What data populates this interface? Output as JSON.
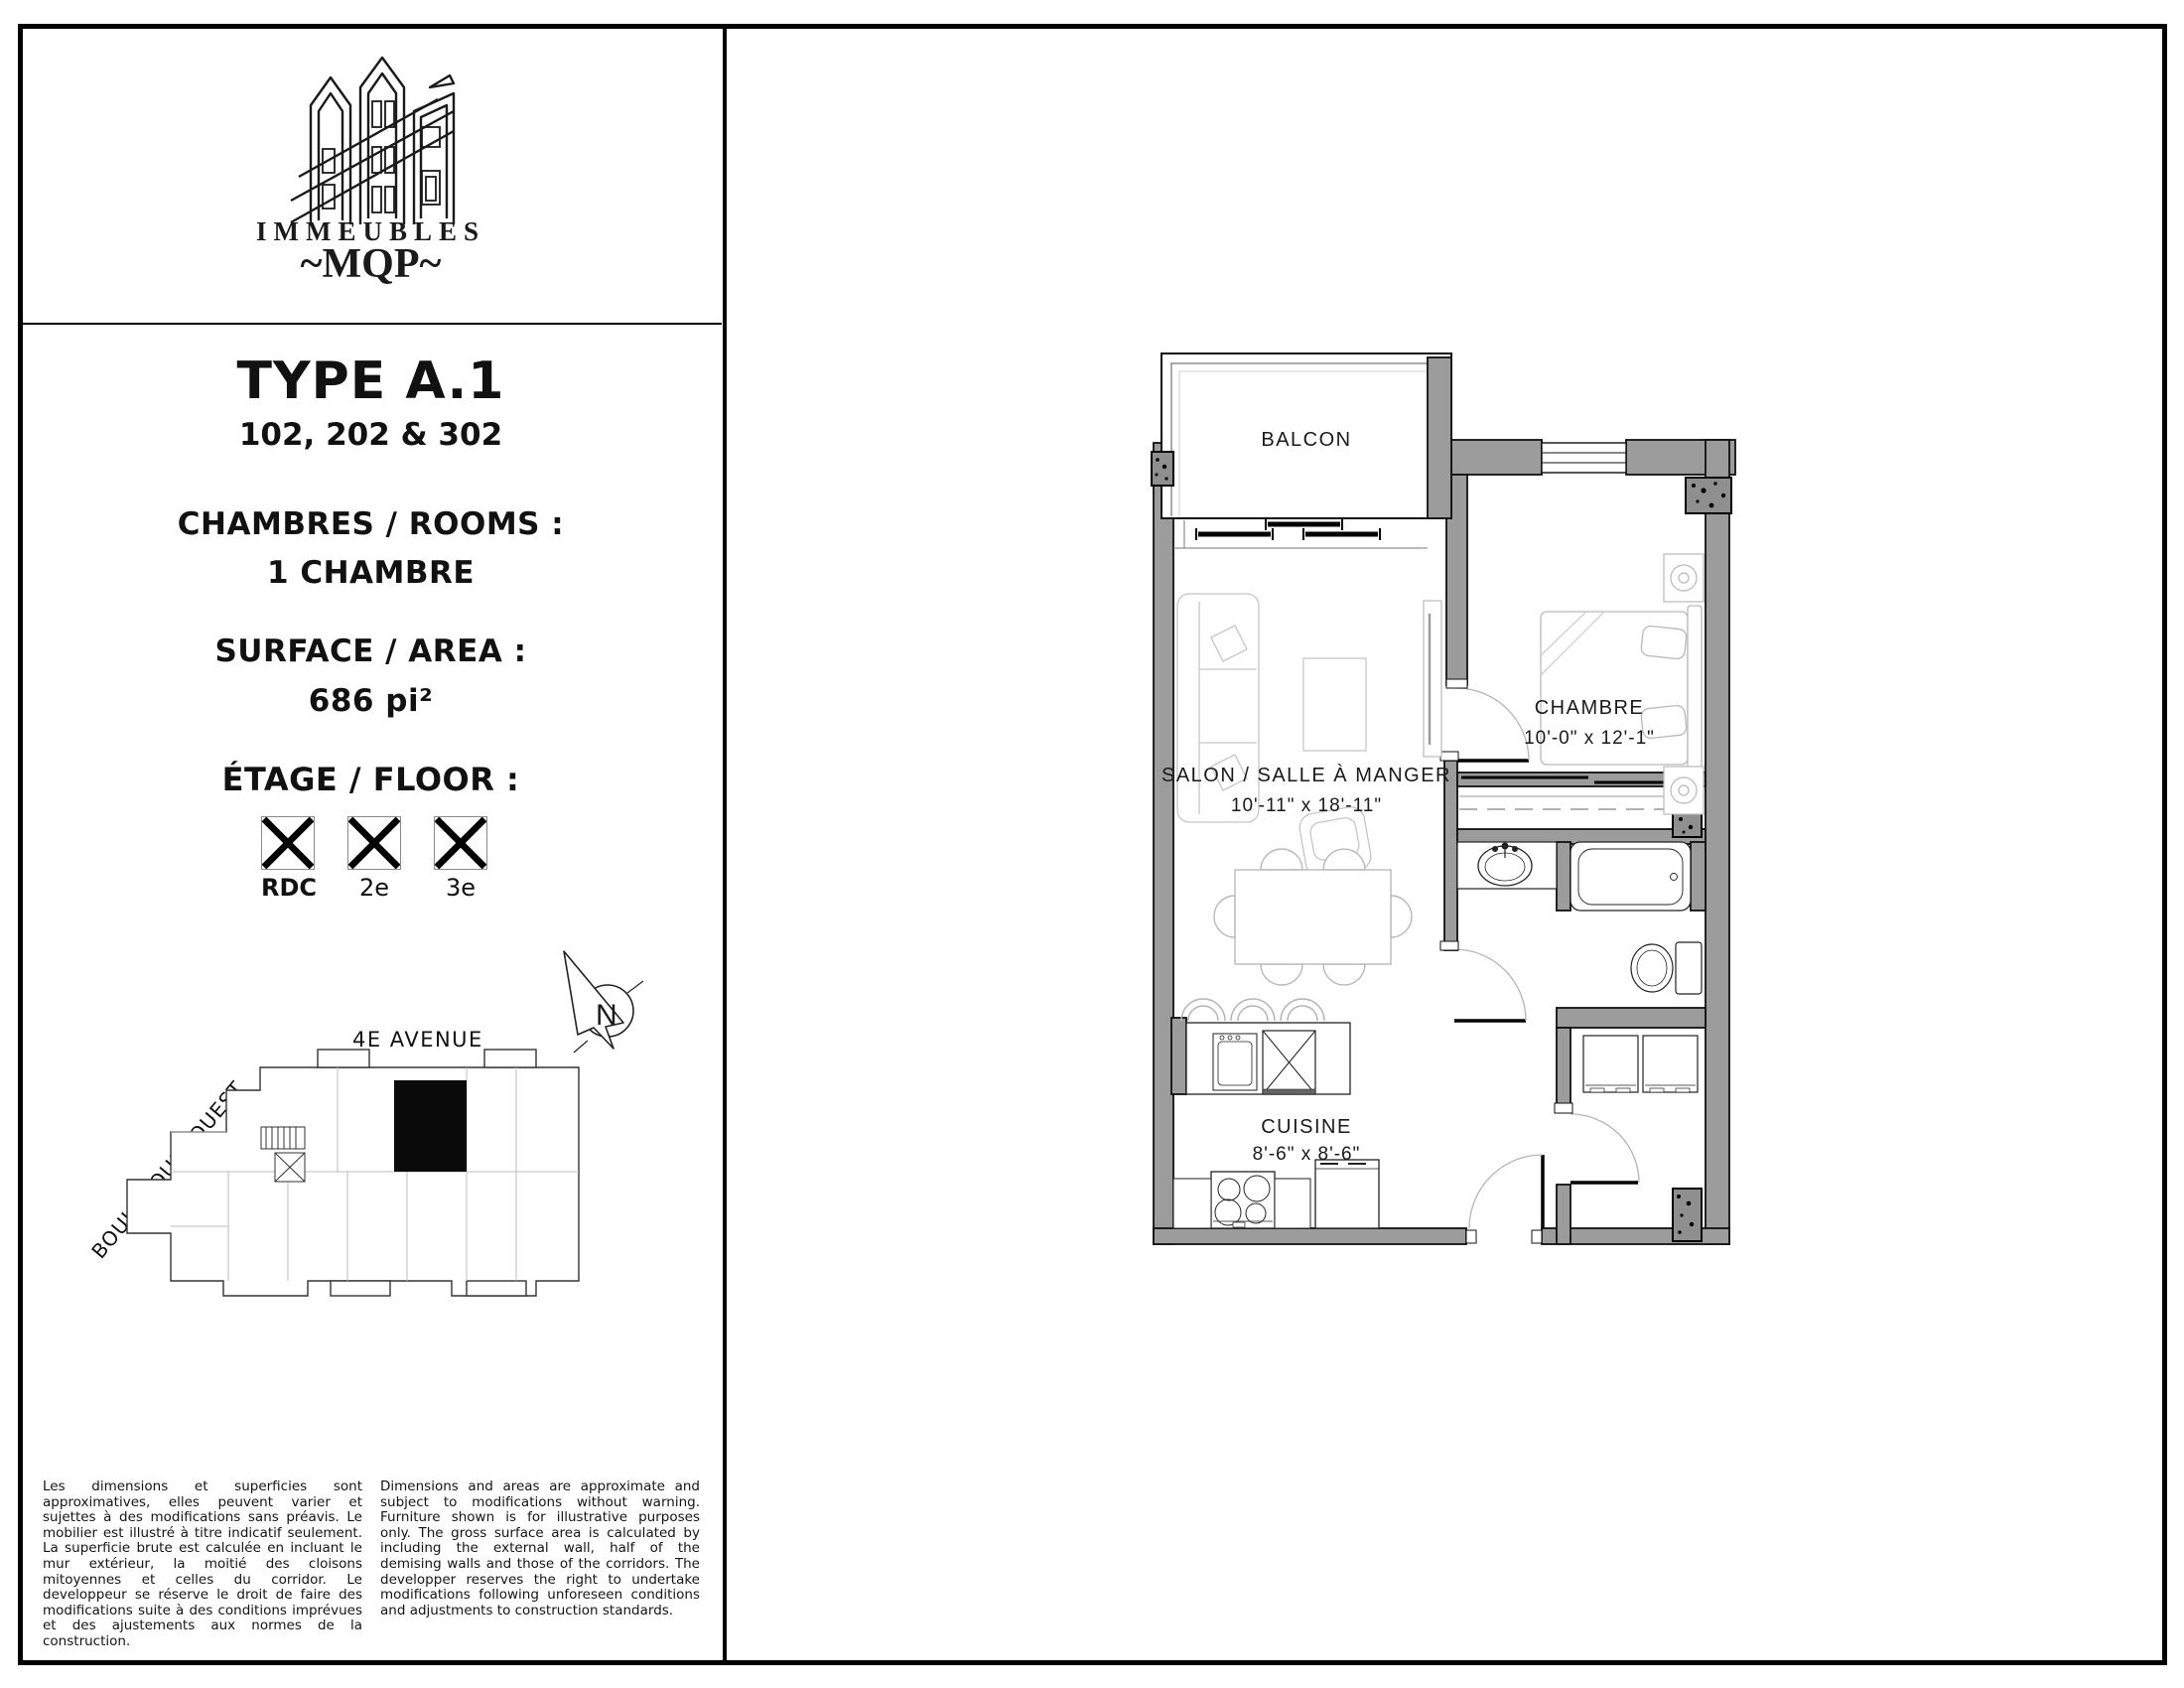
{
  "brand": {
    "name_line": "IMMEUBLES",
    "monogram": "~MQP~"
  },
  "spec": {
    "type_title": "TYPE A.1",
    "unit_numbers": "102, 202 & 302",
    "rooms_label": "CHAMBRES / ROOMS :",
    "rooms_value": "1 CHAMBRE",
    "area_label": "SURFACE / AREA :",
    "area_value": "686 pi²",
    "floor_label": "ÉTAGE / FLOOR :",
    "floors": [
      {
        "label": "RDC"
      },
      {
        "label": "2e"
      },
      {
        "label": "3e"
      }
    ]
  },
  "site": {
    "street_top": "4E AVENUE",
    "street_side": "BOUL. GOUIN OUEST",
    "compass_letter": "N"
  },
  "plan": {
    "rooms": [
      {
        "name": "BALCON",
        "dims": ""
      },
      {
        "name": "CHAMBRE",
        "dims": "10'-0\" x 12'-1\""
      },
      {
        "name": "SALON / SALLE À MANGER",
        "dims": "10'-11\" x 18'-11\""
      },
      {
        "name": "CUISINE",
        "dims": "8'-6\" x 8'-6\""
      }
    ]
  },
  "colors": {
    "wall_gray": "#9c9c9c",
    "ink": "#111111"
  },
  "disclaimer": {
    "fr": "Les dimensions et superficies sont approximatives, elles peuvent varier et sujettes à des modifications sans préavis. Le mobilier est illustré à titre indicatif seulement. La superficie brute est calculée en incluant le mur extérieur, la moitié des cloisons mitoyennes et celles du corridor. Le developpeur se réserve le droit de faire des modifications suite à des conditions imprévues et des ajustements aux normes de la construction.",
    "en": "Dimensions and areas are approximate and subject to modifications without warning. Furniture shown is for illustrative purposes only. The gross surface area is calculated by including the external wall, half of the demising walls and those of the corridors. The developper reserves the right to undertake modifications following unforeseen conditions and adjustments to construction standards."
  }
}
